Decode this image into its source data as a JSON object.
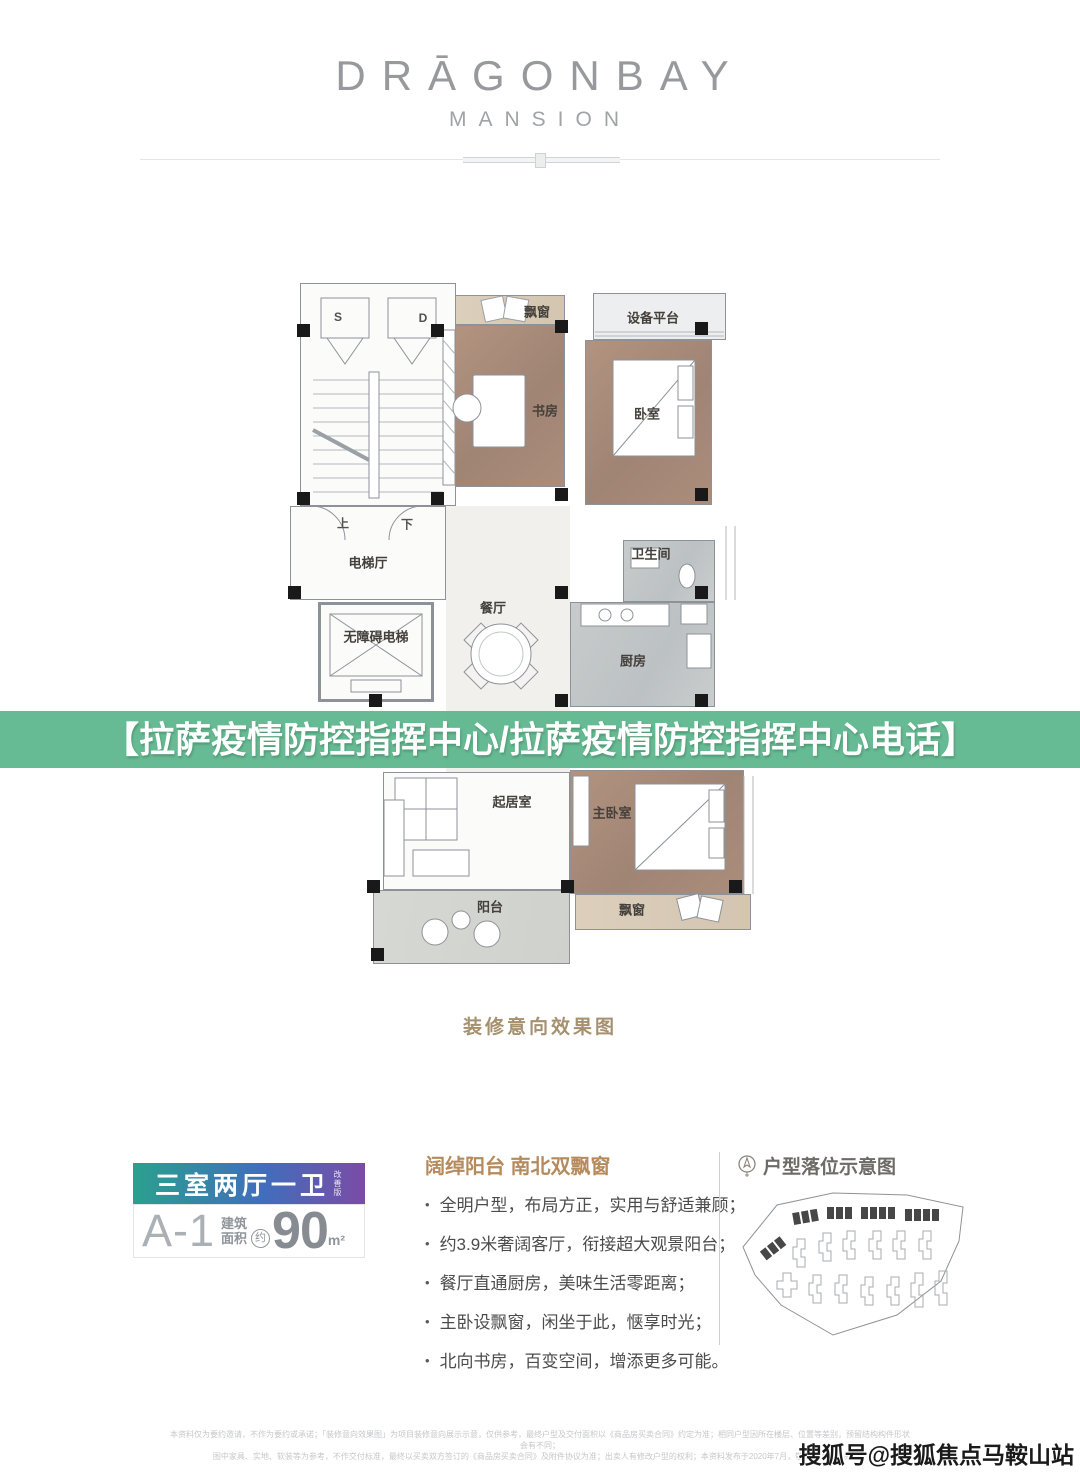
{
  "header": {
    "logo_line1": "DRĀGONBAY",
    "logo_line2": "MANSION"
  },
  "overlay_banner": {
    "text": "【拉萨疫情防控指挥中心/拉萨疫情防控指挥中心电话】",
    "bg_color": "#5cb68c",
    "text_color": "#ffffff"
  },
  "floor_plan": {
    "caption": "装修意向效果图",
    "labels": {
      "shaft_s": "S",
      "shaft_d": "D",
      "bay_window_top": "飘窗",
      "equipment_platform": "设备平台",
      "study": "书房",
      "bedroom": "卧室",
      "stairs_up": "上",
      "stairs_down": "下",
      "elevator_hall": "电梯厅",
      "accessible_elevator": "无障碍电梯",
      "dining": "餐厅",
      "bathroom": "卫生间",
      "kitchen": "厨房",
      "living": "起居室",
      "master_bedroom": "主卧室",
      "balcony": "阳台",
      "bay_window_bottom": "飘窗"
    }
  },
  "unit_card": {
    "type_label": "三室两厅一卫",
    "type_tag": "改善版",
    "unit_code": "A-1",
    "area_label_line1": "建筑",
    "area_label_line2": "面积",
    "approx": "约",
    "area_value": "90",
    "area_unit": "m²",
    "gradient_colors": [
      "#2ba08e",
      "#3f6fbd",
      "#7b4ba6"
    ]
  },
  "features": {
    "title": "阔绰阳台 南北双飘窗",
    "title_color": "#b58a5c",
    "bullets": [
      "全明户型，布局方正，实用与舒适兼顾；",
      "约3.9米奢阔客厅，衔接超大观景阳台；",
      "餐厅直通厨房，美味生活零距离；",
      "主卧设飘窗，闲坐于此，惬享时光；",
      "北向书房，百变空间，增添更多可能。"
    ]
  },
  "location_map": {
    "icon": "compass-icon",
    "title": "户型落位示意图"
  },
  "footer": {
    "disclaimer_line1": "本资料仅为要约邀请，不作为要约或承诺；「装修意向效果图」为项目装修意向展示示意，仅供参考，最终户型及交付面积以《商品房买卖合同》约定为准；相同户型因所在楼层、位置等差别，预留结构构件形状会有不同；",
    "disclaimer_line2": "图中家具、实地、软装等为参考，不作交付标准，最终以买卖双方签订的《商品房买卖合同》及附件协议为准；出卖人有修改户型的权利；本资料发布于2020年7月，敬请留意最新资料。",
    "watermark": "搜狐号@搜狐焦点马鞍山站"
  }
}
